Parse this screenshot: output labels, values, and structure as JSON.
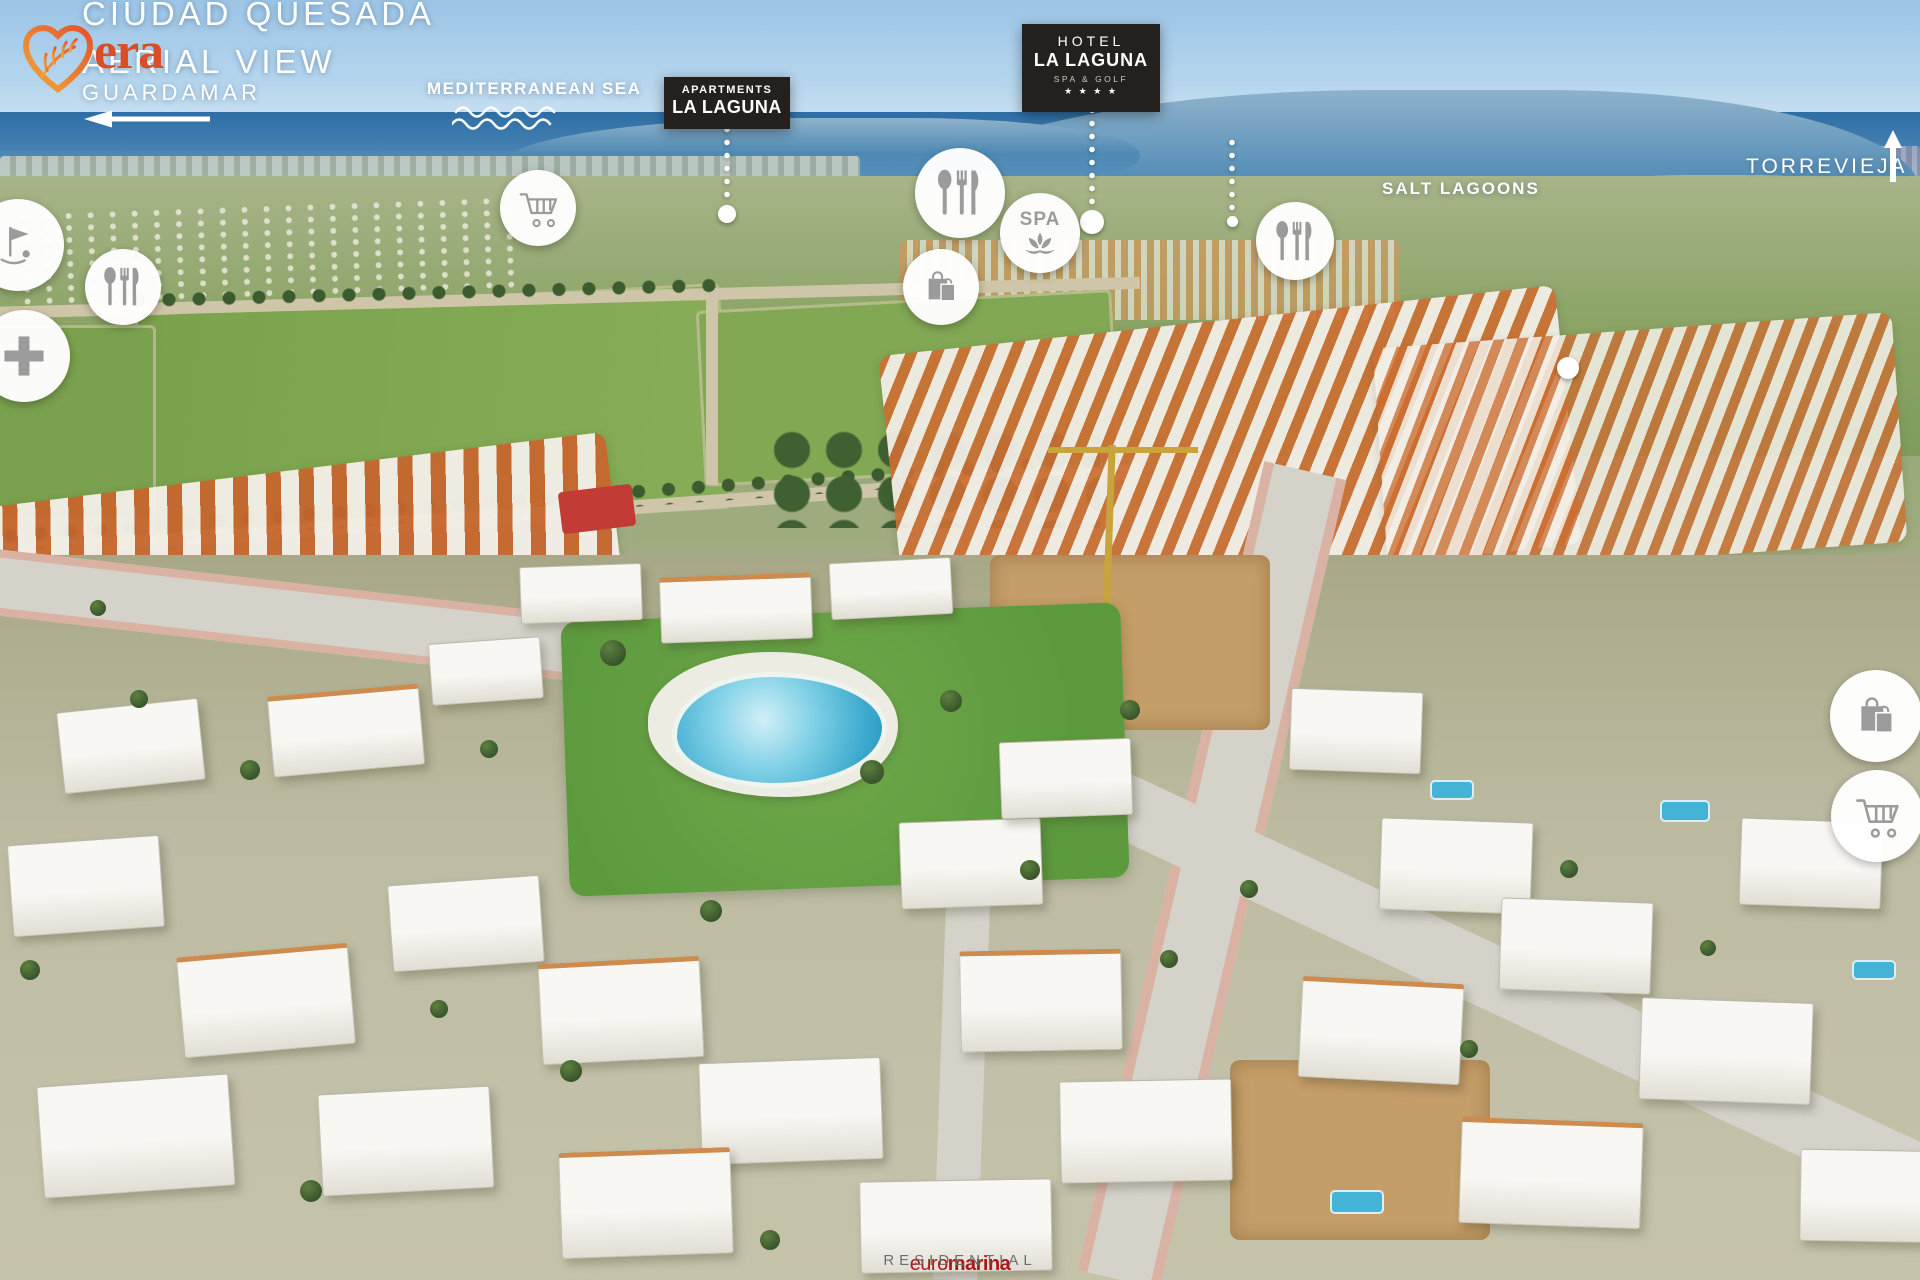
{
  "header": {
    "title_line1": "CIUDAD QUESADA",
    "title_line2": "AERIAL VIEW"
  },
  "direction_labels": {
    "guardamar": "GUARDAMAR",
    "torrevieja": "TORREVIEJA"
  },
  "geo_labels": {
    "mediterranean_sea": "MEDITERRANEAN SEA",
    "salt_lagoons": "SALT LAGOONS"
  },
  "callouts": {
    "apartments_la_laguna": {
      "line1": "APARTMENTS",
      "line2": "LA LAGUNA"
    },
    "hotel_la_laguna": {
      "line1": "HOTEL",
      "line2": "LA LAGUNA",
      "line3": "SPA & GOLF",
      "stars": "★ ★ ★ ★"
    },
    "euromarina": {
      "text_regular": "euro",
      "text_bold": "marina"
    },
    "vera_residential": {
      "wordmark": "era",
      "subtitle": "RESIDENTIAL"
    }
  },
  "amenity_markers": {
    "spa_label": "SPA",
    "icons": [
      "golf-icon",
      "restaurant-icon",
      "medical-cross-icon",
      "shopping-cart-icon",
      "restaurant-icon",
      "spa-icon",
      "shopping-bag-icon",
      "restaurant-icon",
      "shopping-bag-icon",
      "shopping-cart-icon"
    ]
  },
  "colors": {
    "badge_dark": "#23201d",
    "euromarina_red": "#ae1715",
    "vera_orange": "#e8732d",
    "vera_wordmark": "#d84e26",
    "residential_gray": "#6d6e71",
    "icon_gray": "#9b9b9b",
    "label_white": "#ffffff"
  }
}
